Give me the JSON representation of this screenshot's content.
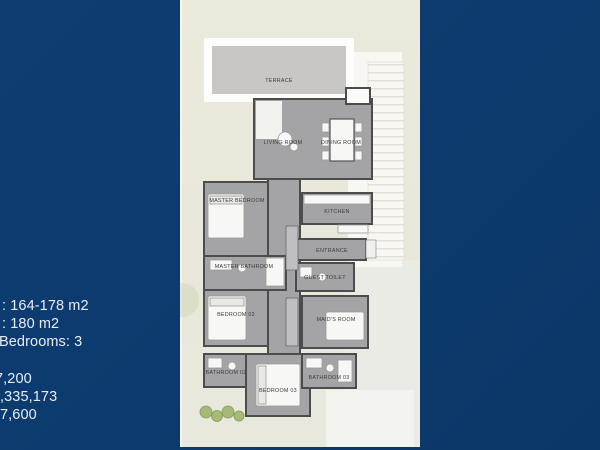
{
  "background_color": "#0d3b6f",
  "info_panel": {
    "lines": [
      {
        "text": ": 164-178 m2"
      },
      {
        "text": ": 180 m2"
      },
      {
        "text": "Bedrooms: 3"
      },
      {
        "text": "7,200"
      },
      {
        "text": ",335,173"
      },
      {
        "text": "7,600"
      }
    ]
  },
  "plan": {
    "labels": [
      {
        "id": "terrace",
        "text": "TERRACE"
      },
      {
        "id": "living-room",
        "text": "LIVING ROOM"
      },
      {
        "id": "dining-room",
        "text": "DINING ROOM"
      },
      {
        "id": "master-bedroom",
        "text": "MASTER BEDROOM"
      },
      {
        "id": "kitchen",
        "text": "KITCHEN"
      },
      {
        "id": "entrance",
        "text": "ENTRANCE"
      },
      {
        "id": "master-bathroom",
        "text": "MASTER BATHROOM"
      },
      {
        "id": "guest-toilet",
        "text": "GUEST TOILET"
      },
      {
        "id": "bedroom-02",
        "text": "BEDROOM 02"
      },
      {
        "id": "maids-room",
        "text": "MAID'S ROOM"
      },
      {
        "id": "bathroom-02",
        "text": "BATHROOM 02"
      },
      {
        "id": "bathroom-03",
        "text": "BATHROOM 03"
      },
      {
        "id": "bedroom-03",
        "text": "BEDROOM 03"
      }
    ],
    "colors": {
      "site_background": "#e9e8db",
      "floor": "#a4a4a6",
      "walls": "#4c4c4e",
      "terrace_fill": "#c8c7c4",
      "furniture": "#f7f7f5",
      "landscape_green": "#9fb56b"
    }
  }
}
